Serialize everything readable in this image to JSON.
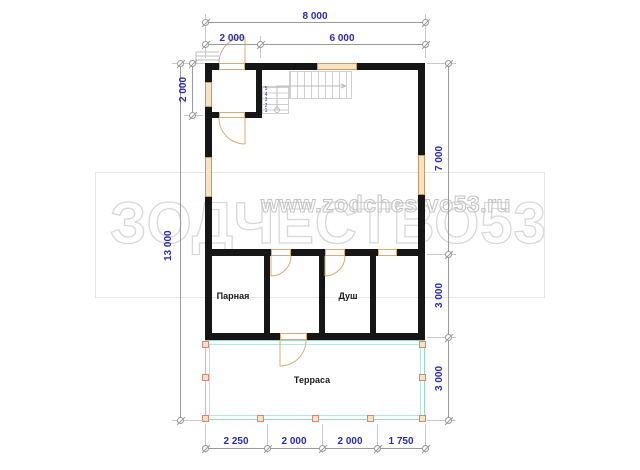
{
  "watermark": {
    "url_text": "www.zodchestvo53.ru",
    "big_text": "ЗОДЧЕСТВО53"
  },
  "dimensions": {
    "top_total": "8 000",
    "top_seg1": "2 000",
    "top_seg2": "6 000",
    "left_upper": "2 000",
    "left_total": "13 000",
    "right_seg1": "7 000",
    "right_seg2": "3 000",
    "right_seg3": "3 000",
    "bottom_seg1": "2 250",
    "bottom_seg2": "2 000",
    "bottom_seg3": "2 000",
    "bottom_seg4": "1 750"
  },
  "rooms": {
    "steam": "Парная",
    "shower": "Душ",
    "terrace": "Терраса"
  },
  "stairs": {
    "numbers_column": "5\n4\n3\n2\n1",
    "numbers_row": "6 7 8 9 10 11 12 13 14 15"
  },
  "colors": {
    "wall": "#161616",
    "dimension_text": "#2b2bb4",
    "window_fill": "#f7e3c2",
    "window_border": "#c59a67",
    "terrace_line": "#96d8cc",
    "watermark_gray": "#d8d8d8"
  }
}
